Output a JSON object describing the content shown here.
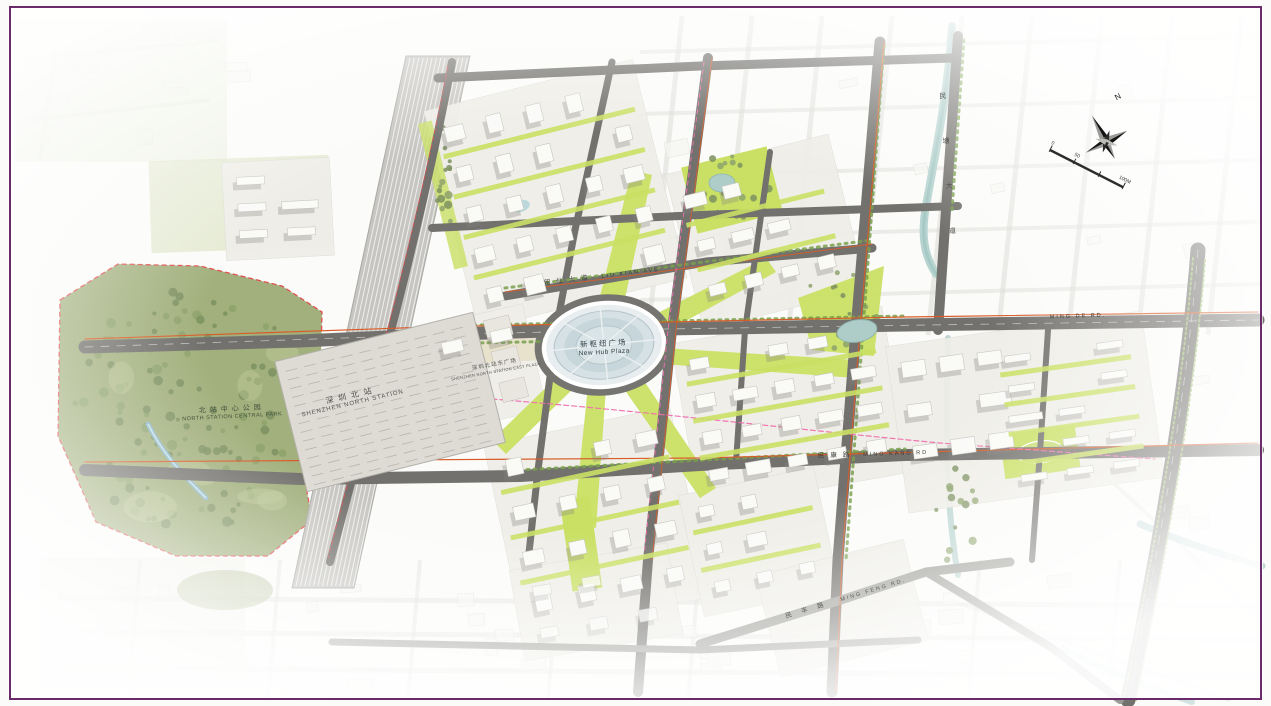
{
  "colors": {
    "frame_purple": "#6b2b6b",
    "road_gray": "#72716d",
    "road_light": "#9a9a95",
    "lime": "#c9e064",
    "lime_dark": "#a9c94e",
    "park_green": "#a2b07d",
    "park_dark": "#7c9160",
    "water_teal": "#b7d4d0",
    "building_white": "#fafaf7",
    "shadow_gray": "#85847f",
    "rail_gray": "#c6c5c1",
    "station_roof": "#dddbd4",
    "accent_orange": "#d85c28",
    "boundary_red": "#e05050",
    "metro_pink": "#ef6fae",
    "sketch_gray": "#dcdcd8",
    "tree_green": "#79a04e"
  },
  "labels": {
    "station": {
      "cn": "深圳北站",
      "en": "SHENZHEN NORTH STATION"
    },
    "hub_plaza": {
      "cn": "新枢纽广场",
      "en": "New Hub Plaza"
    },
    "central_park": {
      "cn": "北站中心公园",
      "en": "NORTH STATION CENTRAL PARK"
    },
    "east_plaza": {
      "cn": "深圳北站东广场",
      "en": "SHENZHEN NORTH STATION EAST PLAZA"
    }
  },
  "road_labels": {
    "liu_xian": {
      "cn": "留仙大道",
      "en": "LIU XIAN AVE"
    },
    "ming_de": {
      "en": "MING DE RD."
    },
    "ming_kang": {
      "cn": "民康路",
      "en": "MING KANG RD"
    },
    "ming_feng": {
      "cn": "民丰路",
      "en": "MING FENG RD."
    },
    "min_tang_ave": {
      "cn": "民塘大道"
    }
  },
  "compass": {
    "north_label": "N"
  },
  "scale_bar": {
    "ticks": [
      "0",
      "50",
      "100M"
    ]
  }
}
